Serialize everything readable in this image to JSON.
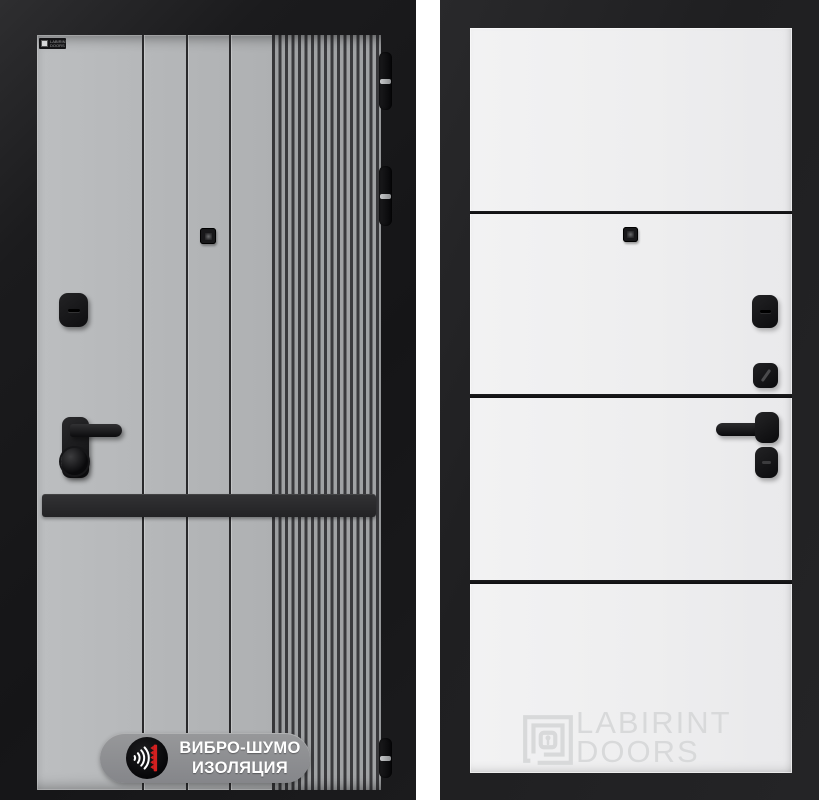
{
  "page": {
    "background": "#ffffff",
    "description": "Product image of a Labirint entry door: exterior grey fluted panel (left) and interior white panel (right)"
  },
  "left_door": {
    "brand_plate": "LABIRINT DOORS",
    "badge": {
      "line1": "ВИБРО-ШУМО",
      "line2": "ИЗОЛЯЦИЯ"
    },
    "colors": {
      "frame": "#1b1b1d",
      "leaf": "#b2b4b6",
      "flute_dark": "#3a3a3d",
      "groove": "#29292b",
      "hardware": "#101012",
      "kick_band": "#2b2b2d",
      "badge_pill": "#8d8e90",
      "badge_icon_red": "#d42020",
      "badge_text": "#ffffff"
    }
  },
  "right_door": {
    "watermark": {
      "line1": "LABIRINT",
      "line2": "DOORS"
    },
    "colors": {
      "frame": "#222224",
      "leaf": "#efeff1",
      "stripe": "#131315",
      "hardware": "#101012",
      "watermark": "#d8d9da"
    }
  }
}
